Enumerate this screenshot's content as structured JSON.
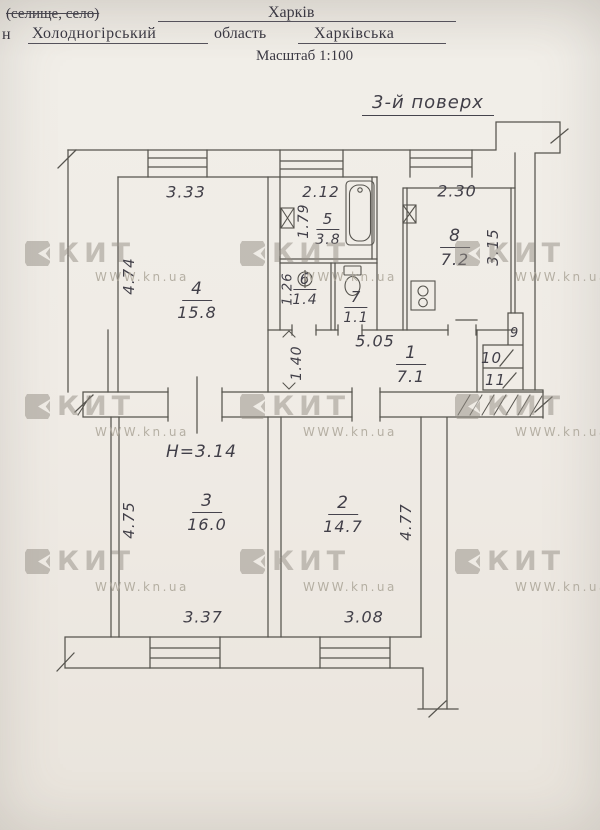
{
  "document": {
    "form_line1": {
      "label_struck": "(селище, село)",
      "value": "Харків"
    },
    "form_line2": {
      "prefix": "н",
      "district": "Холодногірський",
      "label": "область",
      "region": "Харківська"
    },
    "scale": "Масштаб 1:100",
    "floor_title": "3-й поверх"
  },
  "plan": {
    "height_note": "H=3.14",
    "rooms": {
      "r1": {
        "number": "1",
        "area": "7.1"
      },
      "r2": {
        "number": "2",
        "area": "14.7"
      },
      "r3": {
        "number": "3",
        "area": "16.0"
      },
      "r4": {
        "number": "4",
        "area": "15.8"
      },
      "r5": {
        "number": "5",
        "area": "3.8"
      },
      "r6": {
        "number": "6",
        "area": "1.4"
      },
      "r7": {
        "number": "7",
        "area": "1.1"
      },
      "r8": {
        "number": "8",
        "area": "7.2"
      }
    },
    "closets": {
      "c9": "9",
      "c10": "10",
      "c11": "11"
    },
    "dims": {
      "room4_width": "3.33",
      "room4_depth": "4.74",
      "room5_width": "2.12",
      "room5_depth": "1.79",
      "room6_depth": "1.26",
      "room8_width": "2.30",
      "room8_depth": "3.15",
      "hall_length": "5.05",
      "hall_width": "1.40",
      "room3_depth": "4.75",
      "room3_width": "3.37",
      "room2_depth": "4.77",
      "room2_width": "3.08"
    },
    "line_color": "#56544e"
  },
  "watermark": {
    "brand": "КИТ",
    "site": "WWW.kn.ua"
  }
}
